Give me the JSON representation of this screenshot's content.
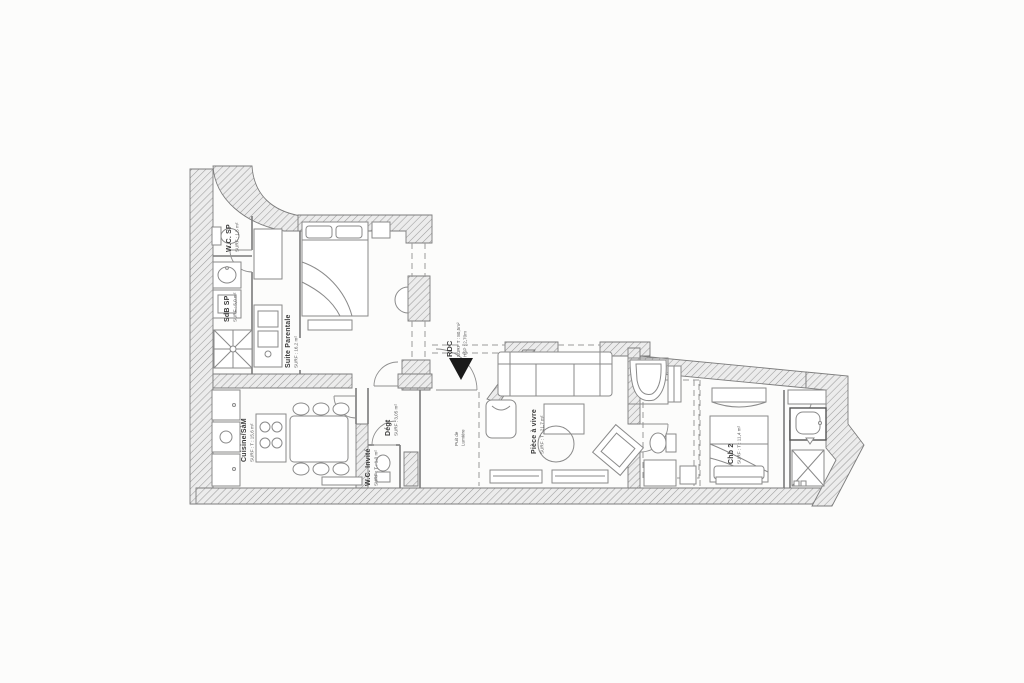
{
  "plan": {
    "entry": {
      "name": "RDC",
      "surface": "SURF T : 80,5m²",
      "height": "HSP : 2,70m",
      "icon": "triangle-down"
    },
    "rooms": {
      "wc_sp": {
        "name": "W.C. SP",
        "surface": "SURF : 1,5 m²"
      },
      "sdb_sp": {
        "name": "SdB SP",
        "surface": "SURF : 5,0 m²"
      },
      "suite_parentale": {
        "name": "Suite Parentale",
        "surface": "SURF : 16,2 m²"
      },
      "cuisine_sam": {
        "name": "Cuisine/SàM",
        "surface": "SURF : T : 15,6 m²"
      },
      "degagement": {
        "name": "Dégt",
        "surface": "SURF : 3,05 m²"
      },
      "wc_invite": {
        "name": "W.C. Invité",
        "surface": "SURF : T : 1,0 m²"
      },
      "piece_a_vivre": {
        "name": "Pièce à vivre",
        "surface": "SURF : T : 21,7 m²"
      },
      "puit_de_lumiere": {
        "name_line1": "Puit de",
        "name_line2": "Lumière"
      },
      "chambre_2": {
        "name": "Chb 2",
        "surface": "SURF : T : 11,4 m²"
      }
    },
    "colors": {
      "background": "#fcfcfb",
      "wall_fill": "#ececec",
      "wall_hatch": "#9c9c9c",
      "line": "#7a7a7a",
      "text": "#3a3a3a",
      "arrow": "#1a1a1a"
    }
  }
}
